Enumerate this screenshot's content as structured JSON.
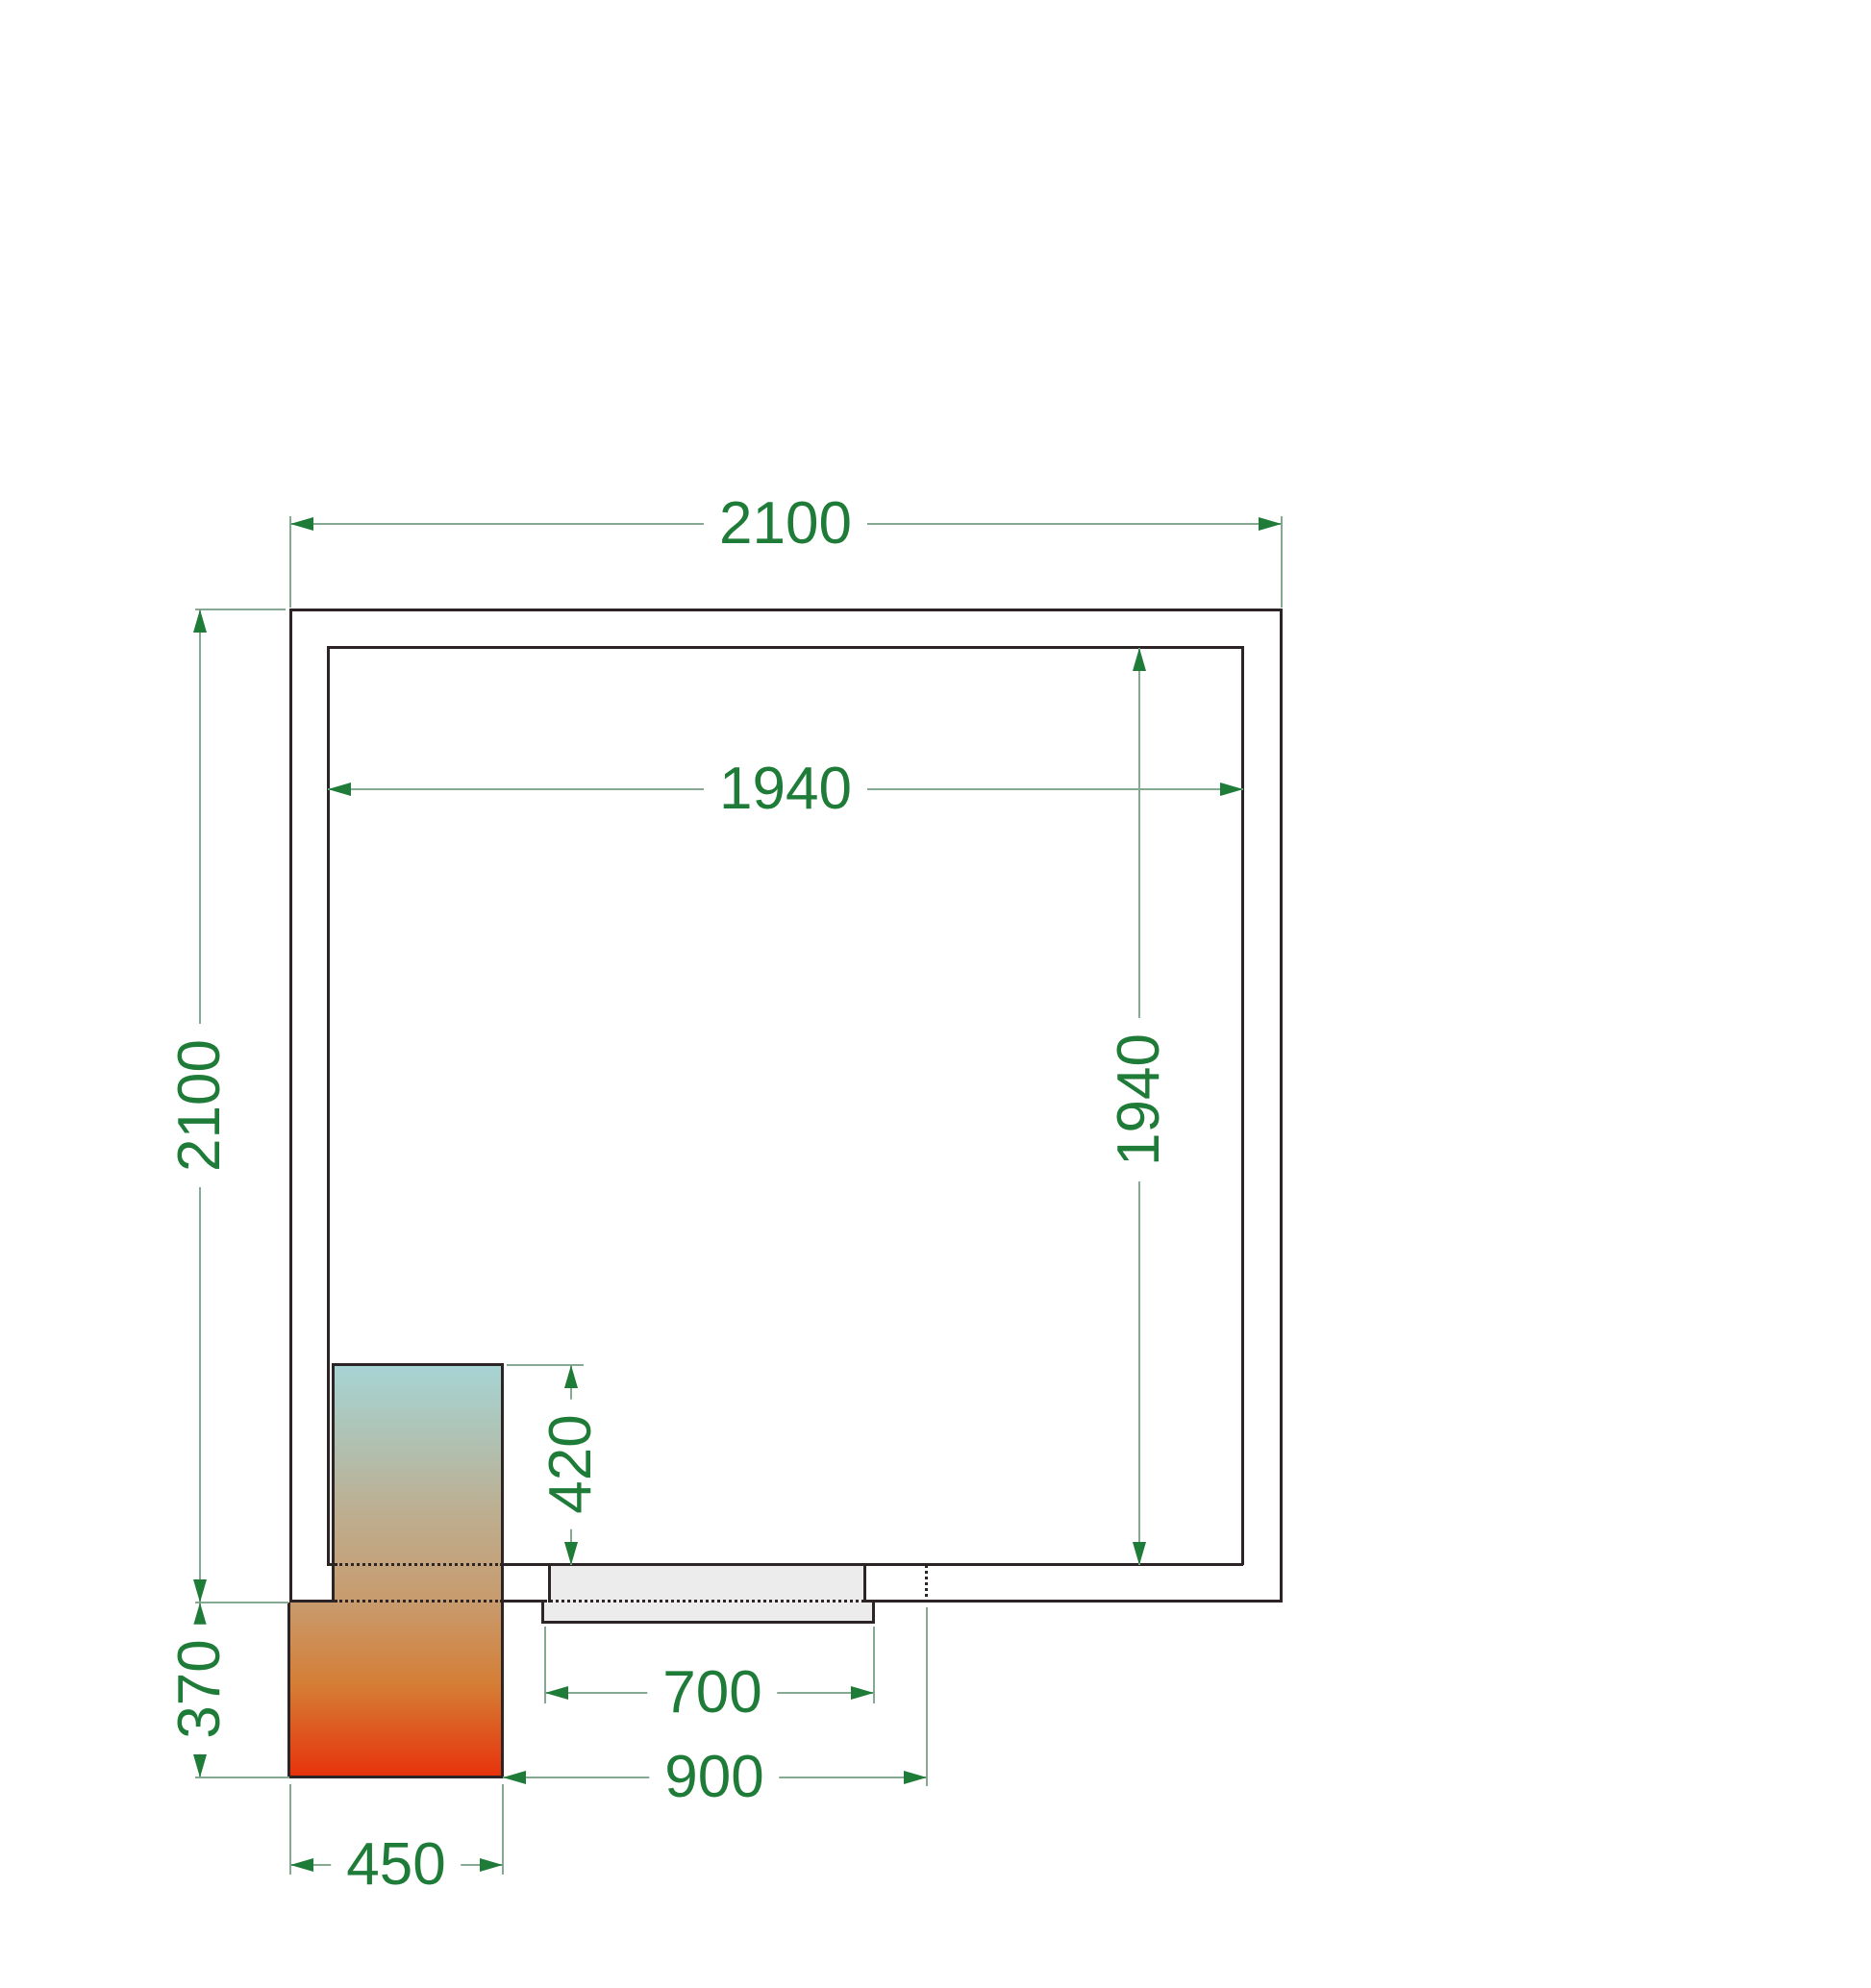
{
  "drawing": {
    "kind": "cold-room floor plan, plan view, CAD style",
    "dimension_labels": {
      "outer_width": "2100",
      "outer_depth": "2100",
      "inner_width": "1940",
      "inner_depth": "1940",
      "unit_depth_inside": "420",
      "unit_depth_outside": "370",
      "door_width": "700",
      "door_clearance": "900",
      "unit_width": "450"
    },
    "colors": {
      "dimension_text_green": "#1e7b38",
      "dimension_line_green": "#86a993",
      "wall_line": "#2d2426",
      "door_fill": "#ececec",
      "unit_gradient_top": "#a6d4d4",
      "unit_gradient_middle": "#c89b6d",
      "unit_gradient_bottom": "#e7330c"
    }
  }
}
